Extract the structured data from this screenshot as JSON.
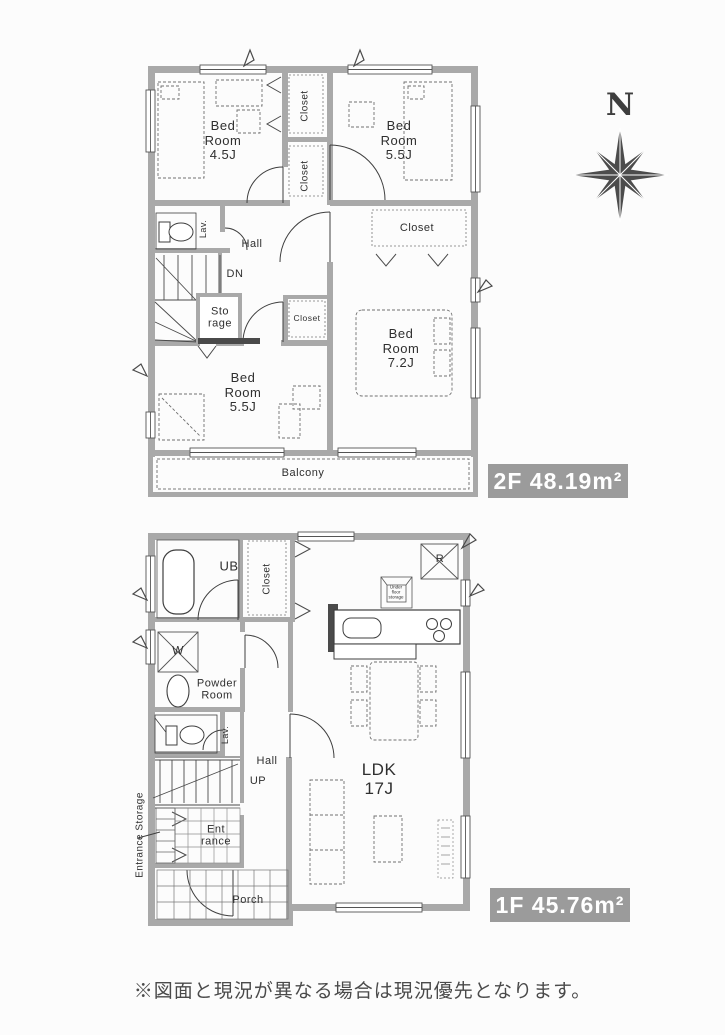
{
  "compass": {
    "north": "N"
  },
  "floor2": {
    "area_badge": "2F 48.19m²",
    "labels": {
      "bedroom_45": "Bed\nRoom\n4.5J",
      "closet_top": "Closet",
      "closet_mid": "Closet",
      "bedroom_55a": "Bed\nRoom\n5.5J",
      "closet_right": "Closet",
      "lav": "Lav.",
      "hall": "Hall",
      "dn": "DN",
      "storage": "Sto\nrage",
      "closet_small": "Closet",
      "bedroom_55b": "Bed\nRoom\n5.5J",
      "bedroom_72": "Bed\nRoom\n7.2J",
      "balcony": "Balcony"
    }
  },
  "floor1": {
    "area_badge": "1F 45.76m²",
    "labels": {
      "ub": "UB",
      "closet": "Closet",
      "fridge": "R",
      "underfloor": "Under\nfloor\nstorage",
      "washer": "W",
      "powder_room": "Powder\nRoom",
      "lav": "Lav.",
      "hall": "Hall",
      "up": "UP",
      "entrance": "Ent\nrance",
      "entrance_storage": "Entrance Storage",
      "porch": "Porch",
      "ldk": "LDK\n17J"
    }
  },
  "footer": {
    "disclaimer": "※図面と現況が異なる場合は現況優先となります。"
  },
  "colors": {
    "wall": "#a9a9a9",
    "line": "#3f3f3f",
    "badge_bg": "#9b9b9b",
    "badge_text": "#ffffff"
  }
}
